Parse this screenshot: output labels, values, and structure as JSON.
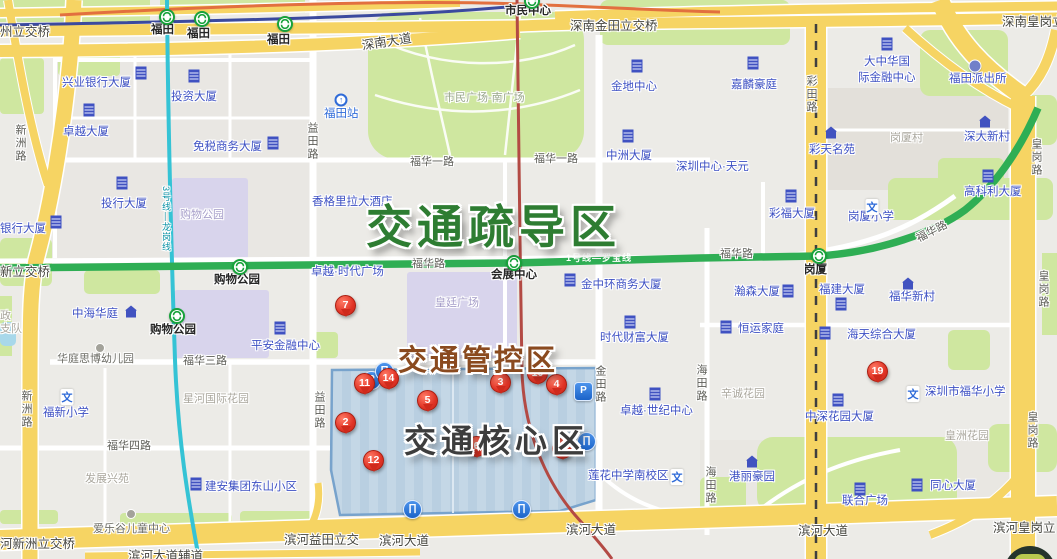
{
  "overlay_titles": {
    "dispersal": {
      "label": "交通疏导区",
      "color": "#2e7d32"
    },
    "control": {
      "label": "交通管控区",
      "color": "#8a4a1f"
    },
    "core": {
      "label": "交通核心区",
      "color": "#3d3d3d"
    }
  },
  "transit": {
    "line1_label": "1号线—罗宝线",
    "line1_color": "#2fae54",
    "line3_label": "3号线—龙岗线",
    "line3_color": "#35c3d5",
    "line4_color": "#b34a44"
  },
  "markers": [
    {
      "n": "7",
      "x": 345,
      "y": 319
    },
    {
      "n": "11",
      "x": 364,
      "y": 397
    },
    {
      "n": "14",
      "x": 388,
      "y": 392
    },
    {
      "n": "2",
      "x": 345,
      "y": 436
    },
    {
      "n": "5",
      "x": 427,
      "y": 414
    },
    {
      "n": "12",
      "x": 373,
      "y": 474
    },
    {
      "n": "3",
      "x": 500,
      "y": 396
    },
    {
      "n": "10",
      "x": 537,
      "y": 387
    },
    {
      "n": "4",
      "x": 556,
      "y": 398
    },
    {
      "n": "6",
      "x": 476,
      "y": 460
    },
    {
      "n": "9",
      "x": 562,
      "y": 462
    },
    {
      "n": "19",
      "x": 877,
      "y": 385
    }
  ],
  "parking_icons": [
    {
      "label": "P",
      "x": 371,
      "y": 380,
      "shape": "circle"
    },
    {
      "label": "P",
      "x": 583,
      "y": 391,
      "shape": "square"
    }
  ],
  "overpass_icons": [
    {
      "label": "∏",
      "x": 384,
      "y": 371
    },
    {
      "label": "∏",
      "x": 586,
      "y": 441
    },
    {
      "label": "∏",
      "x": 412,
      "y": 509
    },
    {
      "label": "∏",
      "x": 521,
      "y": 509
    }
  ],
  "metro_station_icons": [
    {
      "x": 167,
      "y": 17
    },
    {
      "x": 202,
      "y": 19
    },
    {
      "x": 285,
      "y": 24
    },
    {
      "x": 532,
      "y": 1
    },
    {
      "x": 240,
      "y": 267
    },
    {
      "x": 177,
      "y": 316
    },
    {
      "x": 514,
      "y": 263
    },
    {
      "x": 819,
      "y": 256
    }
  ],
  "poi_icons": [
    {
      "type": "building",
      "x": 141,
      "y": 73
    },
    {
      "type": "building",
      "x": 194,
      "y": 76
    },
    {
      "type": "building",
      "x": 89,
      "y": 110
    },
    {
      "type": "building",
      "x": 273,
      "y": 143
    },
    {
      "type": "building",
      "x": 122,
      "y": 183
    },
    {
      "type": "building",
      "x": 56,
      "y": 222
    },
    {
      "type": "building",
      "x": 280,
      "y": 328
    },
    {
      "type": "building",
      "x": 570,
      "y": 280
    },
    {
      "type": "building",
      "x": 637,
      "y": 66
    },
    {
      "type": "building",
      "x": 753,
      "y": 63
    },
    {
      "type": "building",
      "x": 628,
      "y": 136
    },
    {
      "type": "building",
      "x": 887,
      "y": 44
    },
    {
      "type": "building",
      "x": 791,
      "y": 196
    },
    {
      "type": "building",
      "x": 788,
      "y": 291
    },
    {
      "type": "building",
      "x": 841,
      "y": 304
    },
    {
      "type": "building",
      "x": 726,
      "y": 327
    },
    {
      "type": "building",
      "x": 825,
      "y": 333
    },
    {
      "type": "building",
      "x": 988,
      "y": 176
    },
    {
      "type": "building",
      "x": 630,
      "y": 322
    },
    {
      "type": "building",
      "x": 655,
      "y": 394
    },
    {
      "type": "building",
      "x": 838,
      "y": 400
    },
    {
      "type": "building",
      "x": 917,
      "y": 485
    },
    {
      "type": "building",
      "x": 860,
      "y": 489
    },
    {
      "type": "building",
      "x": 196,
      "y": 484
    },
    {
      "type": "home",
      "x": 131,
      "y": 312
    },
    {
      "type": "home",
      "x": 831,
      "y": 133
    },
    {
      "type": "home",
      "x": 985,
      "y": 122
    },
    {
      "type": "home",
      "x": 908,
      "y": 284
    },
    {
      "type": "home",
      "x": 752,
      "y": 462
    },
    {
      "type": "school",
      "x": 67,
      "y": 397,
      "glyph": "文"
    },
    {
      "type": "school",
      "x": 872,
      "y": 207,
      "glyph": "文"
    },
    {
      "type": "school",
      "x": 913,
      "y": 394,
      "glyph": "文"
    },
    {
      "type": "school",
      "x": 677,
      "y": 477,
      "glyph": "文"
    },
    {
      "type": "police",
      "x": 975,
      "y": 66
    },
    {
      "type": "rail",
      "x": 341,
      "y": 100,
      "glyph": "↑"
    },
    {
      "type": "kind",
      "x": 100,
      "y": 348
    },
    {
      "type": "kind",
      "x": 131,
      "y": 514
    }
  ],
  "labels": [
    {
      "t": "州立交桥",
      "x": 0,
      "y": 26,
      "c": "br"
    },
    {
      "t": "深南金田立交桥",
      "x": 570,
      "y": 20,
      "c": "br"
    },
    {
      "t": "深南皇岗立",
      "x": 1002,
      "y": 16,
      "c": "br"
    },
    {
      "t": "新立交桥",
      "x": 0,
      "y": 266,
      "c": "br"
    },
    {
      "t": "河新洲立交桥",
      "x": 0,
      "y": 538,
      "c": "br"
    },
    {
      "t": "滨河益田立交",
      "x": 284,
      "y": 534,
      "c": "br"
    },
    {
      "t": "滨河皇岗立",
      "x": 993,
      "y": 522,
      "c": "br"
    },
    {
      "t": "滨河大道",
      "x": 379,
      "y": 535,
      "c": "br"
    },
    {
      "t": "滨河大道",
      "x": 566,
      "y": 524,
      "c": "br"
    },
    {
      "t": "滨河大道",
      "x": 798,
      "y": 525,
      "c": "br"
    },
    {
      "t": "滨河大道辅道",
      "x": 128,
      "y": 550,
      "c": "br"
    },
    {
      "t": "深南大道",
      "x": 361,
      "y": 40,
      "c": "br",
      "r": -9
    },
    {
      "t": "福华一路",
      "x": 410,
      "y": 157,
      "c": "r"
    },
    {
      "t": "福华一路",
      "x": 534,
      "y": 154,
      "c": "r"
    },
    {
      "t": "福华路",
      "x": 412,
      "y": 259,
      "c": "r"
    },
    {
      "t": "福华路",
      "x": 720,
      "y": 249,
      "c": "r"
    },
    {
      "t": "福华路",
      "x": 915,
      "y": 235,
      "c": "r",
      "r": -27
    },
    {
      "t": "福华三路",
      "x": 183,
      "y": 356,
      "c": "r"
    },
    {
      "t": "福华四路",
      "x": 107,
      "y": 441,
      "c": "r"
    },
    {
      "t": "新洲路",
      "x": 14,
      "y": 124,
      "c": "rv"
    },
    {
      "t": "新洲路",
      "x": 20,
      "y": 390,
      "c": "rv"
    },
    {
      "t": "益田路",
      "x": 306,
      "y": 122,
      "c": "rv"
    },
    {
      "t": "益田路",
      "x": 313,
      "y": 391,
      "c": "rv"
    },
    {
      "t": "金田路",
      "x": 594,
      "y": 365,
      "c": "rv"
    },
    {
      "t": "海田路",
      "x": 695,
      "y": 364,
      "c": "rv"
    },
    {
      "t": "海田路",
      "x": 704,
      "y": 466,
      "c": "rv"
    },
    {
      "t": "皇岗路",
      "x": 1030,
      "y": 138,
      "c": "rv"
    },
    {
      "t": "皇岗路",
      "x": 1037,
      "y": 270,
      "c": "rv"
    },
    {
      "t": "皇岗路",
      "x": 1026,
      "y": 411,
      "c": "rv"
    },
    {
      "t": "彩田路",
      "x": 805,
      "y": 75,
      "c": "rv"
    },
    {
      "t": "兴业银行大厦",
      "x": 62,
      "y": 78,
      "c": "b"
    },
    {
      "t": "投资大厦",
      "x": 171,
      "y": 92,
      "c": "b"
    },
    {
      "t": "卓越大厦",
      "x": 63,
      "y": 127,
      "c": "b"
    },
    {
      "t": "免税商务大厦",
      "x": 193,
      "y": 142,
      "c": "b"
    },
    {
      "t": "投行大厦",
      "x": 101,
      "y": 199,
      "c": "b"
    },
    {
      "t": "银行大厦",
      "x": 0,
      "y": 224,
      "c": "b"
    },
    {
      "t": "中海华庭",
      "x": 72,
      "y": 309,
      "c": "b"
    },
    {
      "t": "平安金融中心",
      "x": 251,
      "y": 341,
      "c": "b"
    },
    {
      "t": "福新小学",
      "x": 43,
      "y": 408,
      "c": "b"
    },
    {
      "t": "建安集团东山小区",
      "x": 205,
      "y": 482,
      "c": "b"
    },
    {
      "t": "金地中心",
      "x": 611,
      "y": 82,
      "c": "b"
    },
    {
      "t": "嘉麟豪庭",
      "x": 731,
      "y": 80,
      "c": "b"
    },
    {
      "t": "中洲大厦",
      "x": 606,
      "y": 151,
      "c": "b"
    },
    {
      "t": "深圳中心·天元",
      "x": 676,
      "y": 162,
      "c": "b"
    },
    {
      "t": "大中华国",
      "x": 864,
      "y": 57,
      "c": "b"
    },
    {
      "t": "际金融中心",
      "x": 858,
      "y": 73,
      "c": "b"
    },
    {
      "t": "福田派出所",
      "x": 949,
      "y": 74,
      "c": "b"
    },
    {
      "t": "彩天名苑",
      "x": 809,
      "y": 145,
      "c": "b"
    },
    {
      "t": "深大新村",
      "x": 964,
      "y": 132,
      "c": "b"
    },
    {
      "t": "高科利大厦",
      "x": 964,
      "y": 187,
      "c": "b"
    },
    {
      "t": "彩福大厦",
      "x": 769,
      "y": 209,
      "c": "b"
    },
    {
      "t": "岗厦小学",
      "x": 848,
      "y": 212,
      "c": "b"
    },
    {
      "t": "瀚森大厦",
      "x": 734,
      "y": 287,
      "c": "b"
    },
    {
      "t": "福建大厦",
      "x": 819,
      "y": 285,
      "c": "b"
    },
    {
      "t": "福华新村",
      "x": 889,
      "y": 292,
      "c": "b"
    },
    {
      "t": "恒运家庭",
      "x": 738,
      "y": 324,
      "c": "b"
    },
    {
      "t": "海天综合大厦",
      "x": 847,
      "y": 330,
      "c": "b"
    },
    {
      "t": "金中环商务大厦",
      "x": 581,
      "y": 280,
      "c": "b"
    },
    {
      "t": "时代财富大厦",
      "x": 600,
      "y": 333,
      "c": "b"
    },
    {
      "t": "卓越·时代广场",
      "x": 311,
      "y": 267,
      "c": "b"
    },
    {
      "t": "香格里拉大酒店",
      "x": 312,
      "y": 197,
      "c": "b"
    },
    {
      "t": "卓越·世纪中心",
      "x": 620,
      "y": 406,
      "c": "b"
    },
    {
      "t": "莲花中学南校区",
      "x": 588,
      "y": 471,
      "c": "b"
    },
    {
      "t": "深圳市福华小学",
      "x": 925,
      "y": 387,
      "c": "b"
    },
    {
      "t": "中深花园大厦",
      "x": 805,
      "y": 412,
      "c": "b"
    },
    {
      "t": "港丽豪园",
      "x": 729,
      "y": 472,
      "c": "b"
    },
    {
      "t": "同心大厦",
      "x": 930,
      "y": 481,
      "c": "b"
    },
    {
      "t": "联合广场",
      "x": 842,
      "y": 496,
      "c": "b"
    },
    {
      "t": "福田站",
      "x": 324,
      "y": 109,
      "c": "b2"
    },
    {
      "t": "爱乐谷儿童中心",
      "x": 93,
      "y": 524,
      "c": "g"
    },
    {
      "t": "华庭思博幼儿园",
      "x": 57,
      "y": 354,
      "c": "g"
    },
    {
      "t": "发展兴苑",
      "x": 85,
      "y": 474,
      "c": "a"
    },
    {
      "t": "星河国际花园",
      "x": 183,
      "y": 394,
      "c": "a"
    },
    {
      "t": "岗厦村",
      "x": 890,
      "y": 133,
      "c": "a"
    },
    {
      "t": "皇洲花园",
      "x": 945,
      "y": 431,
      "c": "a"
    },
    {
      "t": "辛诚花园",
      "x": 721,
      "y": 389,
      "c": "a"
    },
    {
      "t": "政",
      "x": 0,
      "y": 311,
      "c": "a"
    },
    {
      "t": "支队",
      "x": 0,
      "y": 324,
      "c": "a"
    },
    {
      "t": "市民广场-南广场",
      "x": 444,
      "y": 93,
      "c": "pk"
    },
    {
      "t": "购物公园",
      "x": 180,
      "y": 210,
      "c": "p"
    },
    {
      "t": "皇廷广场",
      "x": 435,
      "y": 298,
      "c": "p"
    },
    {
      "t": "福田",
      "x": 151,
      "y": 25,
      "c": "m"
    },
    {
      "t": "福田",
      "x": 187,
      "y": 29,
      "c": "m"
    },
    {
      "t": "福田",
      "x": 267,
      "y": 35,
      "c": "m"
    },
    {
      "t": "市民中心",
      "x": 505,
      "y": 6,
      "c": "m"
    },
    {
      "t": "购物公园",
      "x": 214,
      "y": 275,
      "c": "m"
    },
    {
      "t": "购物公园",
      "x": 150,
      "y": 325,
      "c": "m"
    },
    {
      "t": "会展中心",
      "x": 491,
      "y": 270,
      "c": "m"
    },
    {
      "t": "岗厦",
      "x": 804,
      "y": 265,
      "c": "m"
    },
    {
      "t": "1号线—罗宝线",
      "x": 566,
      "y": 254,
      "c": "w"
    },
    {
      "t": "3号线—龙岗线",
      "x": 161,
      "y": 186,
      "c": "t"
    }
  ]
}
